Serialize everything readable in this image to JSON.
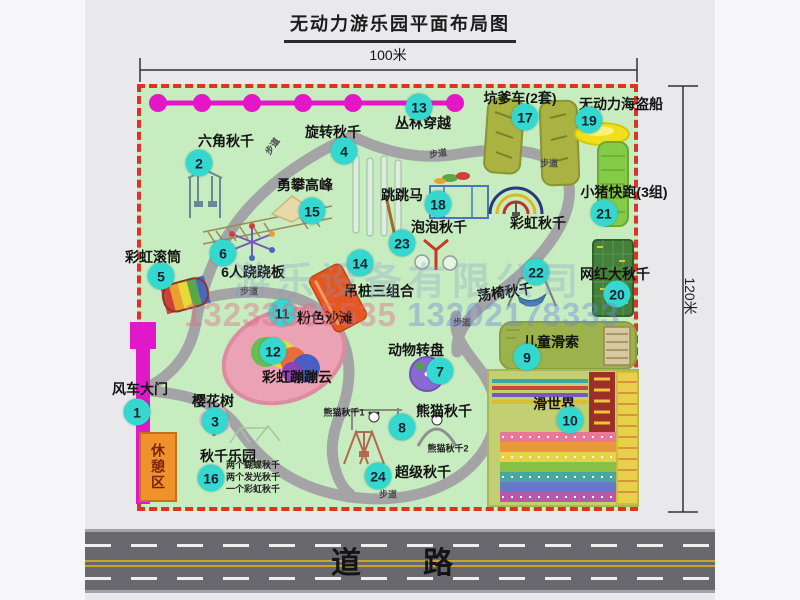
{
  "title": "无动力游乐园平面布局图",
  "dimensions": {
    "width_label": "100米",
    "height_label": "120米"
  },
  "road": {
    "label": "道　路"
  },
  "map": {
    "path_label": "步道"
  },
  "watermark": {
    "company": "游乐设备有限公司",
    "phone1": "13233865535",
    "phone2": "13202178333"
  },
  "colors": {
    "park_green": "#c6ecc0",
    "border_red": "#dd3327",
    "badge_teal": "#35d8cf",
    "gate_magenta": "#e018c8",
    "chain_magenta": "#e516c8",
    "road_gray": "#68686e",
    "rest_area_orange": "#f0922c",
    "path_gray": "#a4a4a6"
  },
  "attractions": {
    "a1": {
      "num": "1",
      "label": "风车大门"
    },
    "a2": {
      "num": "2",
      "label": "六角秋千"
    },
    "a3": {
      "num": "3",
      "label": "樱花树"
    },
    "a4": {
      "num": "4",
      "label": "旋转秋千"
    },
    "a5": {
      "num": "5",
      "label": "彩虹滚筒"
    },
    "a6": {
      "num": "6",
      "label": "6人跷跷板"
    },
    "a7": {
      "num": "7",
      "label": "动物转盘"
    },
    "a8": {
      "num": "8",
      "label": "熊猫秋千"
    },
    "a9": {
      "num": "9",
      "label": "儿童滑索"
    },
    "a10": {
      "num": "10",
      "label": "滑世界"
    },
    "a11": {
      "num": "11",
      "label": "粉色沙滩"
    },
    "a12": {
      "num": "12",
      "label": "彩虹蹦蹦云"
    },
    "a13": {
      "num": "13",
      "label": "丛林穿越"
    },
    "a14": {
      "num": "14",
      "label": "吊桩三组合"
    },
    "a15": {
      "num": "15",
      "label": "勇攀高峰"
    },
    "a16": {
      "num": "16",
      "label": "秋千乐园",
      "sub": [
        "两个蝴蝶秋千",
        "两个发光秋千",
        "一个彩虹秋千"
      ]
    },
    "a17": {
      "num": "17",
      "label": "坑爹车(2套)"
    },
    "a18": {
      "num": "18",
      "label": "跳跳马"
    },
    "a19": {
      "num": "19",
      "label": "无动力海盗船"
    },
    "a20": {
      "num": "20",
      "label": "网红大秋千"
    },
    "a21": {
      "num": "21",
      "label": "小猪快跑(3组)"
    },
    "a22": {
      "num": "22",
      "label": "荡椅秋千"
    },
    "a23": {
      "num": "23",
      "label": "泡泡秋千"
    },
    "a24": {
      "num": "24",
      "label": "超级秋千"
    },
    "rainbow_swing": {
      "label": "彩虹秋千"
    },
    "panda1": {
      "label": "熊猫秋千1"
    },
    "panda2": {
      "label": "熊猫秋千2"
    },
    "rest_area": {
      "label": "休憩区"
    }
  }
}
